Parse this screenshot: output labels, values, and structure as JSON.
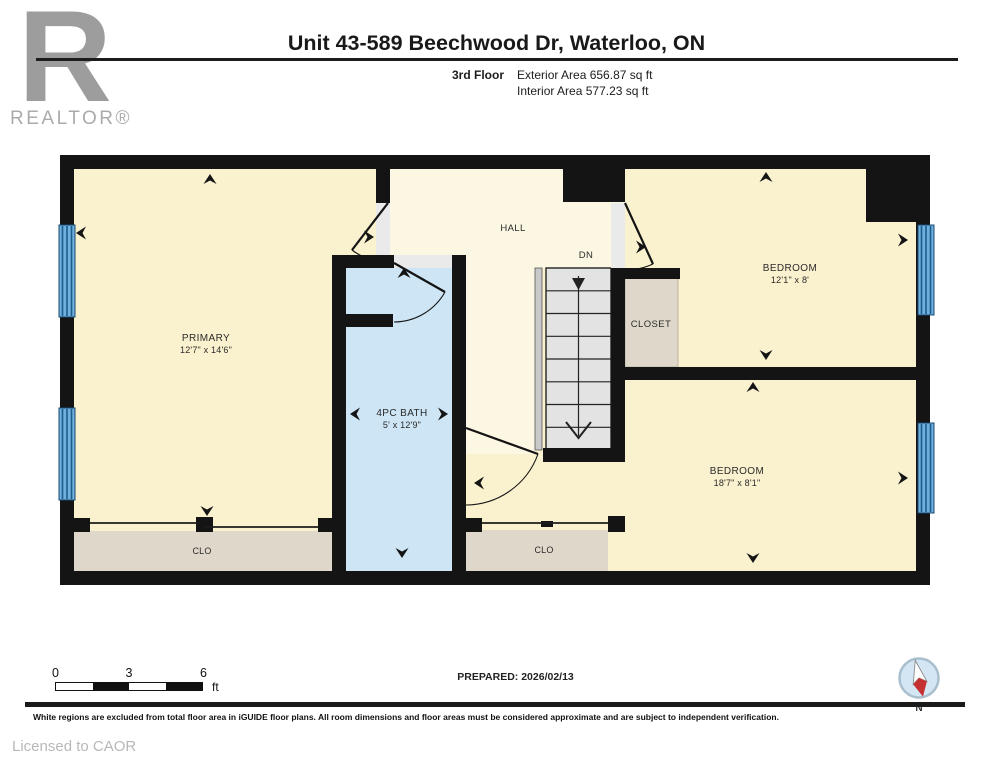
{
  "header": {
    "logo_letter": "R",
    "logo_word": "REALTOR®",
    "title": "Unit 43-589 Beechwood Dr, Waterloo, ON",
    "floor_label": "3rd Floor",
    "exterior_area": "Exterior Area 656.87 sq ft",
    "interior_area": "Interior Area 577.23 sq ft"
  },
  "plan": {
    "hall": "HALL",
    "dn": "DN",
    "primary": {
      "name": "PRIMARY",
      "dims": "12'7\" x 14'6\""
    },
    "bath": {
      "name": "4PC BATH",
      "dims": "5' x 12'9\""
    },
    "closet": "CLOSET",
    "bedroom1": {
      "name": "BEDROOM",
      "dims": "12'1\" x 8'"
    },
    "bedroom2": {
      "name": "BEDROOM",
      "dims": "18'7\" x 8'1\""
    },
    "clo1": "CLO",
    "clo2": "CLO"
  },
  "footer": {
    "scale": {
      "t0": "0",
      "t3": "3",
      "t6": "6",
      "unit": "ft"
    },
    "prepared": "PREPARED: 2026/02/13",
    "compass_label": "N",
    "disclaimer": "White regions are excluded from total floor area in iGUIDE floor plans. All room dimensions and floor areas must be considered approximate and are subject to independent verification.",
    "licensed": "Licensed to CAOR"
  },
  "colors": {
    "wall": "#141414",
    "room_fill": "#FAF1CE",
    "hall_fill": "#FCF7E3",
    "bath_fill": "#CDE5F4",
    "closet_fill": "#DFD8CA",
    "window_blue": "#6FB0DD",
    "stair_fill": "#E3E3E3",
    "compass_red": "#C53030"
  }
}
